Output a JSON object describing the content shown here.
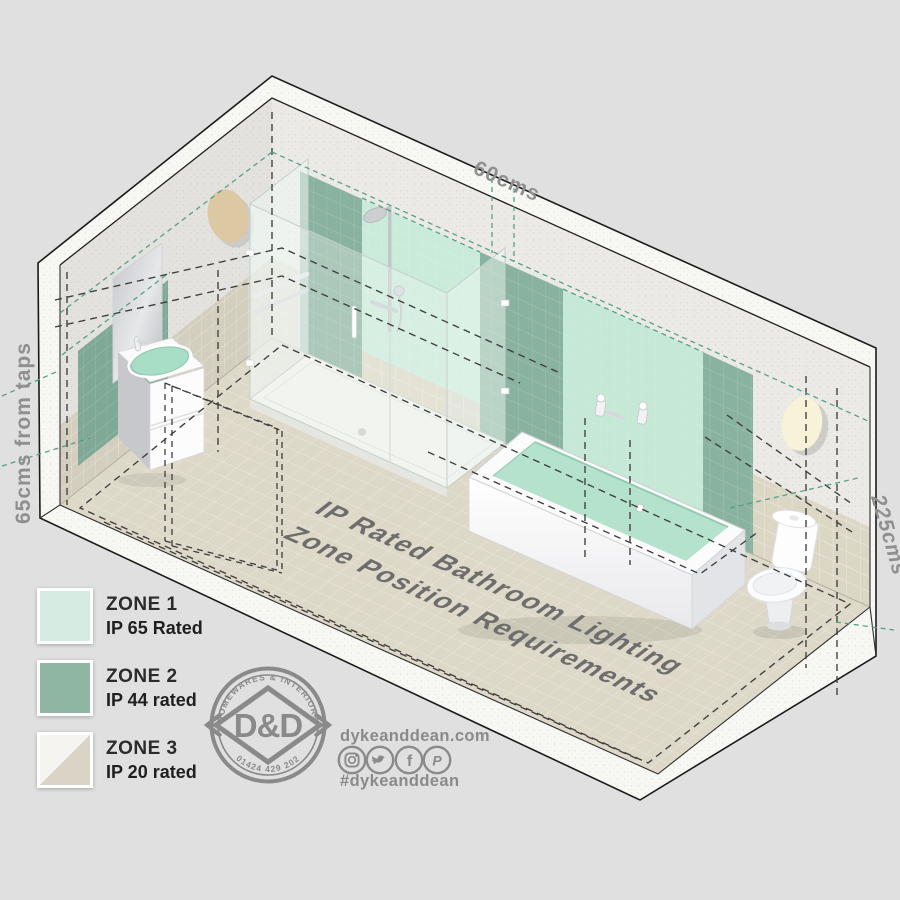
{
  "title": {
    "line1": "IP Rated Bathroom Lighting",
    "line2": "Zone Position Requirements"
  },
  "measurements": {
    "width_top": "60cms",
    "height_left": "65cms from taps",
    "height_right": "225cms"
  },
  "legend": {
    "items": [
      {
        "zone": "ZONE 1",
        "rating": "IP 65 Rated",
        "swatch_color": "#d6ece2"
      },
      {
        "zone": "ZONE 2",
        "rating": "IP 44 rated",
        "swatch_color": "#8fb6a3"
      },
      {
        "zone": "ZONE 3",
        "rating": "IP 20 rated",
        "swatch_color_top": "#f5f4f1",
        "swatch_color_bottom": "#d9d4c5"
      }
    ]
  },
  "logo": {
    "arc_top": "HOMEWARES & INTERIORS",
    "arc_bottom": "01424 429 202",
    "monogram": "D&D"
  },
  "contact": {
    "website": "dykeanddean.com",
    "hashtag": "#dykeanddean",
    "social_icons": [
      "instagram-icon",
      "twitter-icon",
      "facebook-icon",
      "pinterest-icon"
    ],
    "glyph_facebook": "f",
    "glyph_pinterest": "P"
  },
  "colors": {
    "background": "#e0e0e0",
    "zone1_mint": "#cbebda",
    "zone2_green": "#8ab2a0",
    "zone3_tile": "#d9d4c5",
    "dashed_teal": "#4f9f87",
    "dashed_black": "#3d3d3d",
    "label_gray": "#8f8f8f",
    "brand_gray": "#8a8a8a"
  }
}
